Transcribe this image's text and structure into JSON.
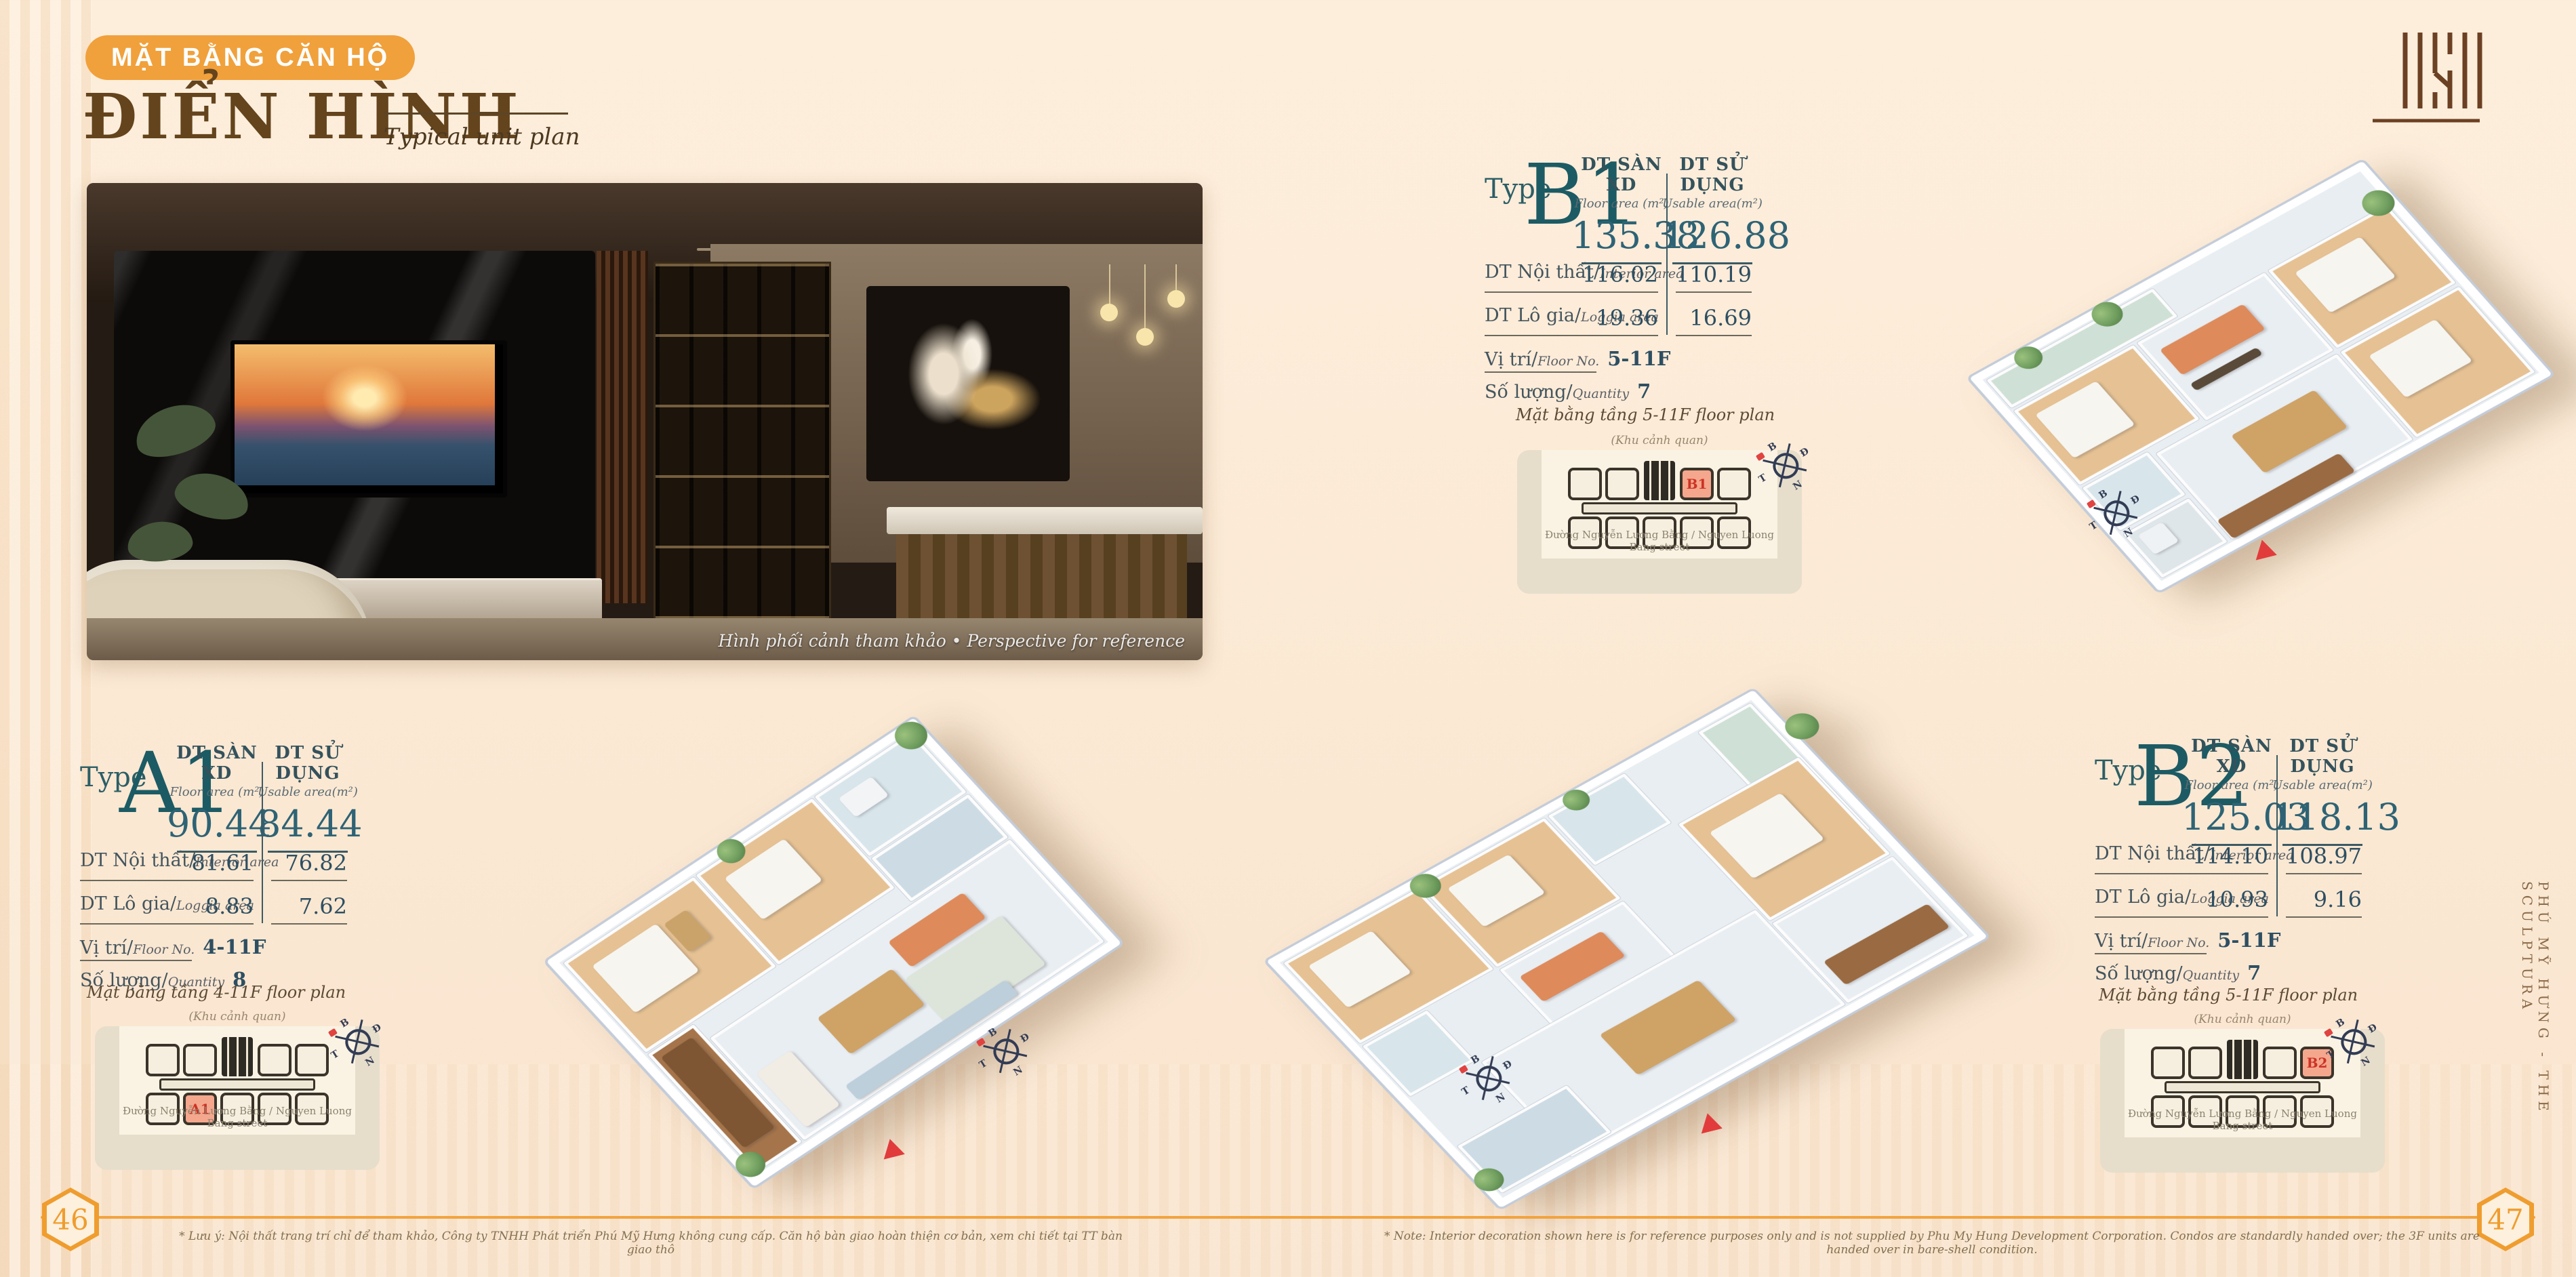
{
  "page": {
    "badge": "MẶT BẰNG CĂN HỘ",
    "title": "ĐIỂN HÌNH",
    "subtitle": "Typical unit plan",
    "side_text": "PHÚ MỸ HƯNG - THE SCULPTURA",
    "page_left": "46",
    "page_right": "47",
    "photo_caption": "Hình phối cảnh tham khảo • Perspective for reference",
    "note_vi": "* Lưu ý: Nội thất trang trí chỉ để tham khảo, Công ty TNHH Phát triển Phú Mỹ Hưng không cung cấp. Căn hộ bàn giao hoàn thiện cơ bản, xem chi tiết tại TT bàn giao thô",
    "note_en": "* Note: Interior decoration shown here is for reference purposes only and is not supplied by Phu My Hung Development Corporation. Condos are standardly handed over; the 3F units are handed over in bare-shell condition."
  },
  "labels": {
    "type": "Type",
    "floor_area": "DT SÀN XD",
    "floor_area_sub": "Floor area (m²)",
    "usable_area": "DT SỬ DỤNG",
    "usable_area_sub": "Usable area(m²)",
    "interior": "DT Nội thất/",
    "interior_sub": "Interior area",
    "loggia": "DT Lô gia/",
    "loggia_sub": "Loggia area",
    "position": "Vị trí/",
    "position_sub": "Floor No.",
    "quantity": "Số lượng/",
    "quantity_sub": "Quantity",
    "keyplan_top": "(Khu cảnh quan)",
    "keyplan_bottom": "Đường Nguyễn Lương Bằng / Nguyen Luong Bang street"
  },
  "units": [
    {
      "name": "A1",
      "floor_area": "90.44",
      "usable_area": "84.44",
      "interior": [
        "81.61",
        "76.82"
      ],
      "loggia": [
        "8.83",
        "7.62"
      ],
      "floors": "4-11F",
      "quantity": "8",
      "keyplan_title": "Mặt bằng tầng 4-11F floor plan"
    },
    {
      "name": "B1",
      "floor_area": "135.38",
      "usable_area": "126.88",
      "interior": [
        "116.02",
        "110.19"
      ],
      "loggia": [
        "19.36",
        "16.69"
      ],
      "floors": "5-11F",
      "quantity": "7",
      "keyplan_title": "Mặt bằng tầng 5-11F floor plan"
    },
    {
      "name": "B2",
      "floor_area": "125.03",
      "usable_area": "118.13",
      "interior": [
        "114.10",
        "108.97"
      ],
      "loggia": [
        "10.93",
        "9.16"
      ],
      "floors": "5-11F",
      "quantity": "7",
      "keyplan_title": "Mặt bằng tầng 5-11F floor plan"
    }
  ],
  "compass": {
    "n": "B",
    "e": "Đ",
    "s": "N",
    "w": "T"
  },
  "colors": {
    "accent_orange": "#F1A13B",
    "teal": "#1C5A64",
    "brown": "#63441D",
    "highlight": "#F4A78C",
    "highlight_text": "#CC3325"
  }
}
